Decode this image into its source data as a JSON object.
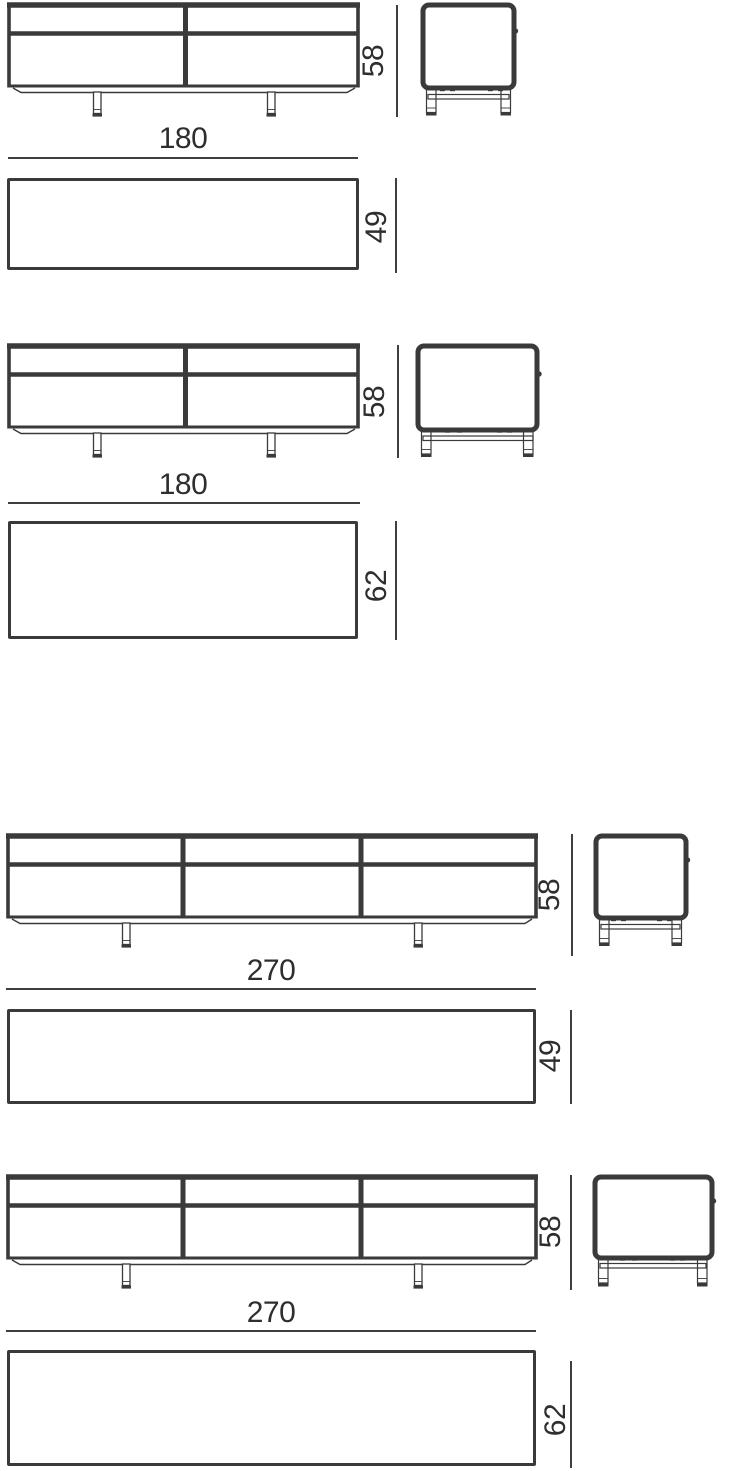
{
  "colors": {
    "line": "#3a3a3a",
    "thin_line": "#3f3f3f",
    "text": "#2e2e2e",
    "background": "#ffffff"
  },
  "diagram_data": {
    "type": "furniture-dimension-drawing",
    "description_visible_text_only": true,
    "variants": [
      {
        "drawers": 2,
        "views": [
          "front",
          "side",
          "plan"
        ],
        "width": "180",
        "height": "58",
        "depth": "49"
      },
      {
        "drawers": 2,
        "views": [
          "front",
          "side",
          "plan"
        ],
        "width": "180",
        "height": "58",
        "depth": "62"
      },
      {
        "drawers": 3,
        "views": [
          "front",
          "side",
          "plan"
        ],
        "width": "270",
        "height": "58",
        "depth": "49"
      },
      {
        "drawers": 3,
        "views": [
          "front",
          "side",
          "plan"
        ],
        "width": "270",
        "height": "58",
        "depth": "62"
      }
    ]
  }
}
